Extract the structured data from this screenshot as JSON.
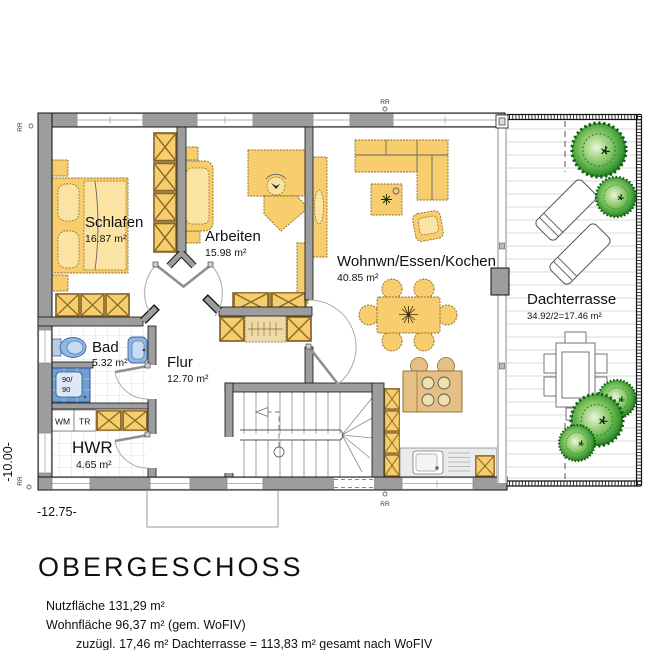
{
  "floorplan": {
    "title": "OBERGESCHOSS",
    "rooms": {
      "schlafen": {
        "name": "Schlafen",
        "area": "16.87 m²"
      },
      "arbeiten": {
        "name": "Arbeiten",
        "area": "15.98 m²"
      },
      "wohnen": {
        "name": "Wohnwn/Essen/Kochen",
        "area": "40.85 m²"
      },
      "bad": {
        "name": "Bad",
        "area": "5.32 m²"
      },
      "flur": {
        "name": "Flur",
        "area": "12.70 m²"
      },
      "hwr": {
        "name": "HWR",
        "area": "4.65 m²"
      },
      "dachterrasse": {
        "name": "Dachterrasse",
        "area": "34.92/2=17.46 m²"
      }
    },
    "labels": {
      "wm": "WM",
      "tr": "TR",
      "shower_l1": "90/",
      "shower_l2": "90",
      "rr": "RR"
    },
    "dimensions": {
      "height": "-10.00-",
      "width": "-12.75-"
    },
    "summary": {
      "line1": "Nutzfläche 131,29 m²",
      "line2": "Wohnfläche 96,37 m² (gem. WoFIV)",
      "line3": "zuzügl. 17,46 m² Dachterrasse = 113,83 m² gesamt nach WoFIV"
    },
    "colors": {
      "wall": "#9d9d9d",
      "furniture": "#f7cd6d",
      "fixture_blue": "#91b6e2",
      "plant_green": "#2e8b2e",
      "deck_line": "#cccccc"
    }
  }
}
